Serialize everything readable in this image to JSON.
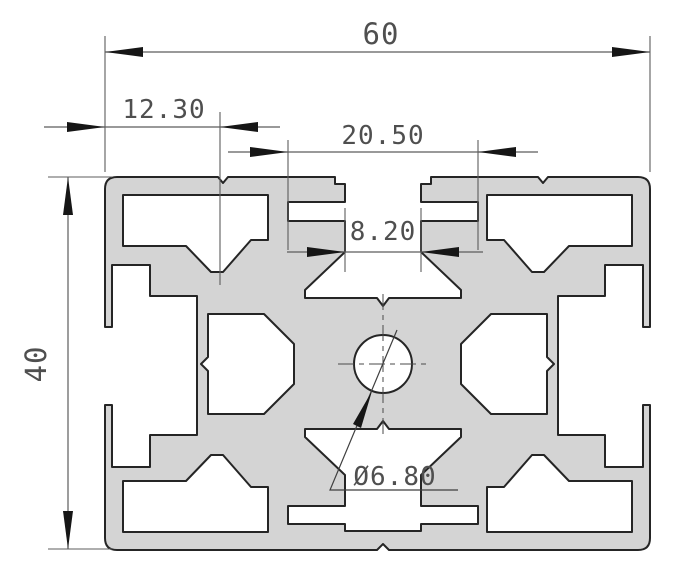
{
  "drawing": {
    "type": "technical-cross-section",
    "subject": "aluminum-extrusion-profile-60x40",
    "dimensions": {
      "overall_width": {
        "label": "60",
        "orientation": "horizontal"
      },
      "overall_height": {
        "label": "40",
        "orientation": "vertical"
      },
      "slot_offset": {
        "label": "12.30",
        "orientation": "horizontal"
      },
      "slot_outer": {
        "label": "20.50",
        "orientation": "horizontal"
      },
      "slot_opening": {
        "label": "8.20",
        "orientation": "horizontal"
      },
      "center_bore": {
        "label": "Ø6.80",
        "orientation": "leader"
      }
    },
    "colors": {
      "profile_fill": "#d4d4d4",
      "profile_outline": "#252525",
      "dimension_lines": "#5c5c5c",
      "dimension_text": "#4f4f4f",
      "background": "#ffffff"
    }
  }
}
